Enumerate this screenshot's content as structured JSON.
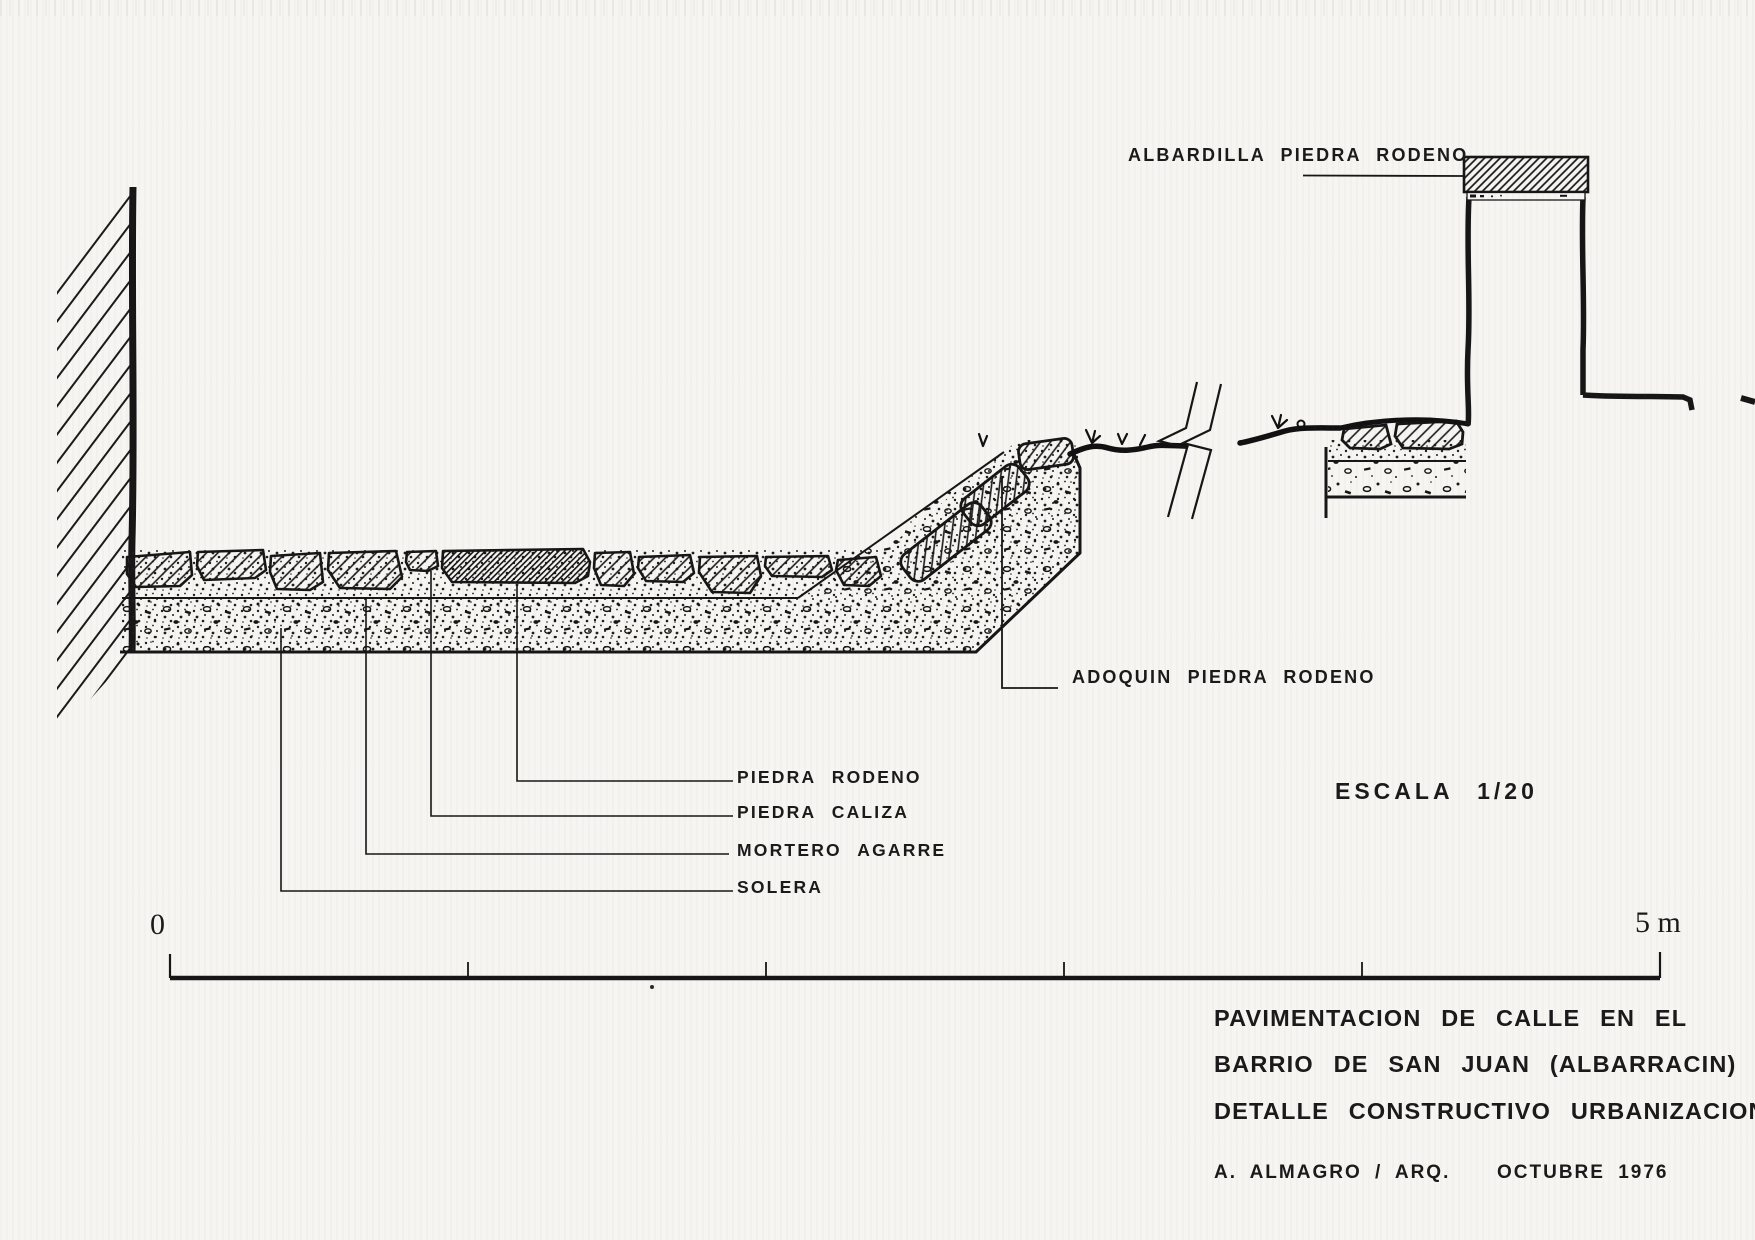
{
  "drawing": {
    "kind": "construction-detail-section",
    "colors": {
      "ink": "#161616",
      "paper": "#f6f5f2"
    },
    "labels": {
      "albardilla": "ALBARDILLA PIEDRA RODENO",
      "adoquin": "ADOQUIN PIEDRA RODENO",
      "piedra_rodeno": "PIEDRA RODENO",
      "piedra_caliza": "PIEDRA CALIZA",
      "mortero_agarre": "MORTERO AGARRE",
      "solera": "SOLERA",
      "escala": "ESCALA 1/20"
    },
    "scale_bar": {
      "start": "0",
      "end": "5 m",
      "divisions": 5
    },
    "title_block": {
      "line1": "PAVIMENTACION DE CALLE EN EL",
      "line2": "BARRIO DE SAN JUAN (ALBARRACIN)",
      "line3": "DETALLE CONSTRUCTIVO URBANIZACION",
      "author": "A. ALMAGRO / ARQ.",
      "date": "OCTUBRE 1976"
    }
  }
}
